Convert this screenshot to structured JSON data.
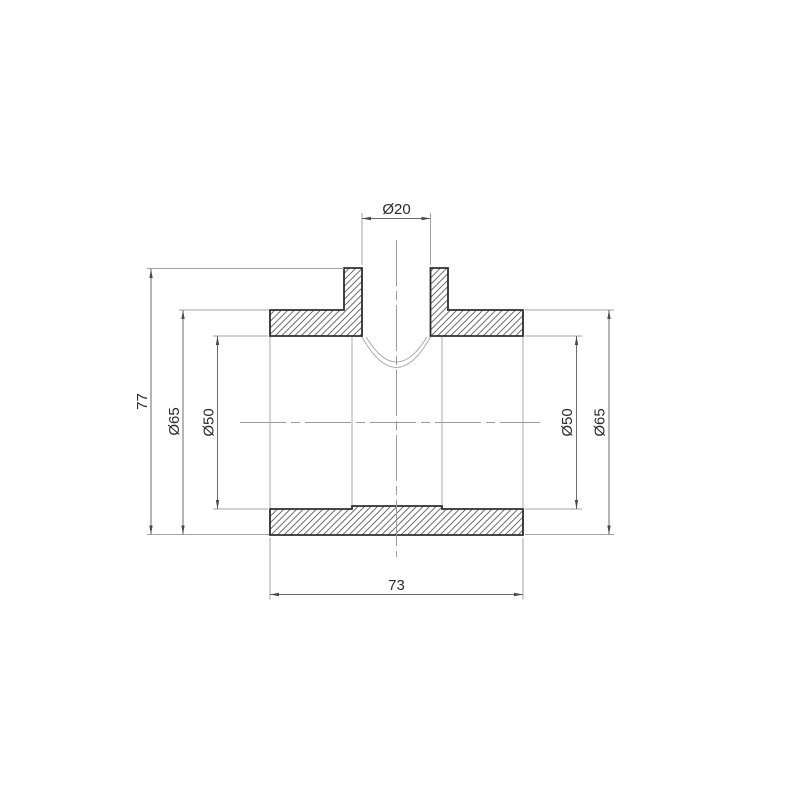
{
  "drawing": {
    "kind": "technical-section-drawing",
    "dimension_labels": {
      "branch_bore": "Ø20",
      "overall_height": "77",
      "outer_diameter_left": "Ø65",
      "bore_diameter_left": "Ø50",
      "bore_diameter_right": "Ø50",
      "outer_diameter_right": "Ø65",
      "overall_width": "73"
    },
    "colors": {
      "background": "#ffffff",
      "outline": "#2e2e2e",
      "hatch": "#5f5f5f",
      "thin_edge": "#ababab",
      "centerline": "#9a9a9a",
      "dimension_line": "#6b6b6b",
      "extension_line": "#a3a3a3",
      "arrow": "#4a4a4a",
      "text": "#2b2b2b"
    }
  }
}
